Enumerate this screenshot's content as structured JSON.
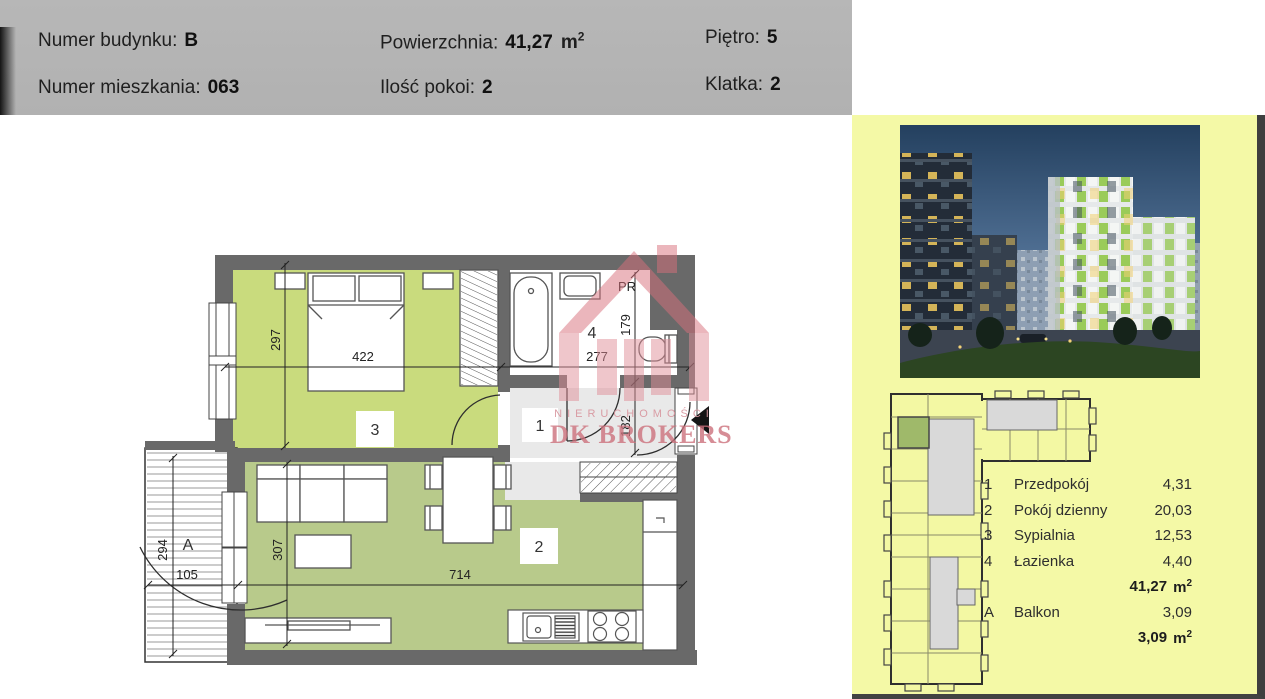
{
  "header": {
    "building_label": "Numer budynku:",
    "building_value": "B",
    "apartment_label": "Numer mieszkania:",
    "apartment_value": "063",
    "area_label": "Powierzchnia:",
    "area_value": "41,27",
    "rooms_label": "Ilość pokoi:",
    "rooms_value": "2",
    "floor_label": "Piętro:",
    "floor_value": "5",
    "staircase_label": "Klatka:",
    "staircase_value": "2",
    "unit_base": "m",
    "unit_sup": "2"
  },
  "floorplan": {
    "dim_bedroom_width": "422",
    "dim_bedroom_height": "297",
    "dim_bath_width": "277",
    "dim_bath_height": "179",
    "dim_hall_height": "182",
    "dim_living_width": "714",
    "dim_living_height": "307",
    "dim_balcony_height": "294",
    "dim_balcony_width": "105",
    "num_hall": "1",
    "num_living": "2",
    "num_bedroom": "3",
    "num_bath": "4",
    "num_balcony": "A",
    "washer_label": "PR"
  },
  "watermark": {
    "line1": "NIERUCHOMOŚCI",
    "line2": "DK BROKERS"
  },
  "legend": {
    "rows": [
      {
        "num": "1",
        "name": "Przedpokój",
        "area": "4,31"
      },
      {
        "num": "2",
        "name": "Pokój dzienny",
        "area": "20,03"
      },
      {
        "num": "3",
        "name": "Sypialnia",
        "area": "12,53"
      },
      {
        "num": "4",
        "name": "Łazienka",
        "area": "4,40"
      }
    ],
    "total_value": "41,27",
    "balcony_num": "A",
    "balcony_name": "Balkon",
    "balcony_area": "3,09",
    "balcony_total_value": "3,09",
    "unit_base": "m",
    "unit_sup": "2"
  },
  "colors": {
    "panel_yellow": "#f4f9a6",
    "wall_gray": "#696969",
    "bedroom_green": "#c9db7d",
    "living_green": "#b8ca8b",
    "hall_gray": "#e9e9e9",
    "highlight_green": "#9fb96a",
    "watermark_pink": "#d9707c",
    "header_gray": "#b3b3b3"
  }
}
